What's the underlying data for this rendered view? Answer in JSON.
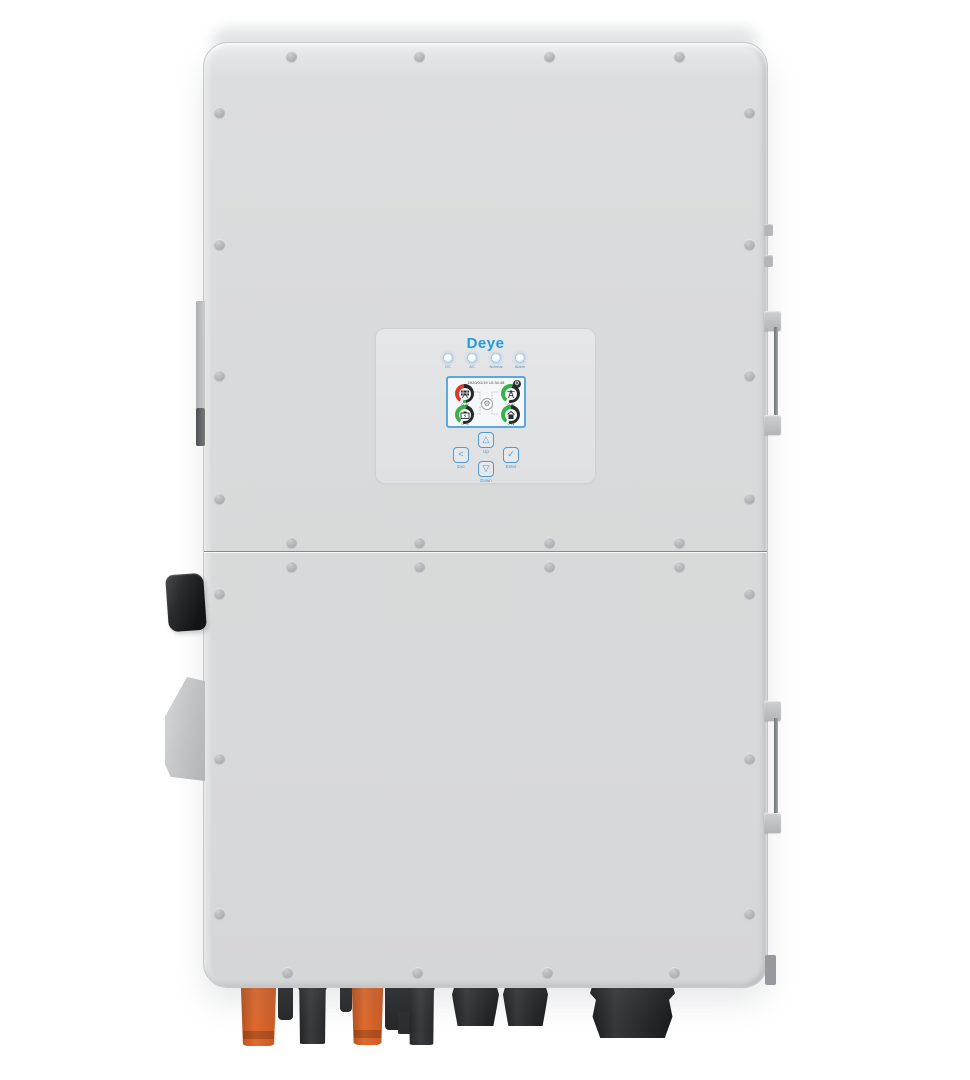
{
  "brand": {
    "logo_text": "Deye",
    "logo_color": "#1f9cdc"
  },
  "panel": {
    "leds": [
      {
        "name": "dc-led",
        "label": "DC"
      },
      {
        "name": "ac-led",
        "label": "AC"
      },
      {
        "name": "normal-led",
        "label": "Normal"
      },
      {
        "name": "alarm-led",
        "label": "Alarm"
      }
    ],
    "screen": {
      "datetime": "2020/01/19 10:34:48",
      "gear_icon": "settings-gear-icon",
      "center_icon": "inverter-icon",
      "gauges": [
        {
          "position": "top-left",
          "icon": "solar-panel-icon",
          "arc_colors": [
            "#d93a2d",
            "#25282a",
            "#35b24a"
          ],
          "value": "0 W"
        },
        {
          "position": "top-right",
          "icon": "power-grid-icon",
          "arc_colors": [
            "#35b24a",
            "#25282a"
          ],
          "value": "0 W"
        },
        {
          "position": "bottom-left",
          "icon": "battery-icon",
          "arc_colors": [
            "#35b24a",
            "#25282a"
          ],
          "value": "0 %"
        },
        {
          "position": "bottom-right",
          "icon": "home-load-icon",
          "arc_colors": [
            "#35b24a",
            "#25282a"
          ],
          "value": "0 W"
        }
      ]
    },
    "buttons": [
      {
        "name": "esc",
        "glyph": "<",
        "label": "Esc"
      },
      {
        "name": "up",
        "glyph": "△",
        "label": "Up"
      },
      {
        "name": "down",
        "glyph": "▽",
        "label": "Down"
      },
      {
        "name": "enter",
        "glyph": "✓",
        "label": "Enter"
      }
    ]
  },
  "hardware": {
    "screw_icon": "phillips-screw",
    "side_attachments": [
      "mount-rail-left",
      "dc-switch-knob",
      "carry-handle-left",
      "carry-handle-right-upper",
      "carry-handle-right-lower"
    ],
    "bottom_connectors": [
      "mc4-connector-orange",
      "cable-stub-black",
      "mc4-connector-black",
      "cable-stub-black",
      "mc4-connector-orange",
      "ac-connector-black",
      "mc4-connector-black",
      "cable-gland",
      "cable-gland",
      "large-cable-gland"
    ]
  },
  "colors": {
    "background": "#ffffff",
    "case": "#d9dadb",
    "panel": "#e2e3e5",
    "accent_blue": "#1f9cdc",
    "button_blue": "#4d9ad6",
    "lcd_border": "#58a9e0",
    "arc_red": "#d93a2d",
    "arc_green": "#35b24a",
    "arc_dark": "#25282a",
    "connector_orange": "#dd6830",
    "connector_black": "#232426"
  }
}
